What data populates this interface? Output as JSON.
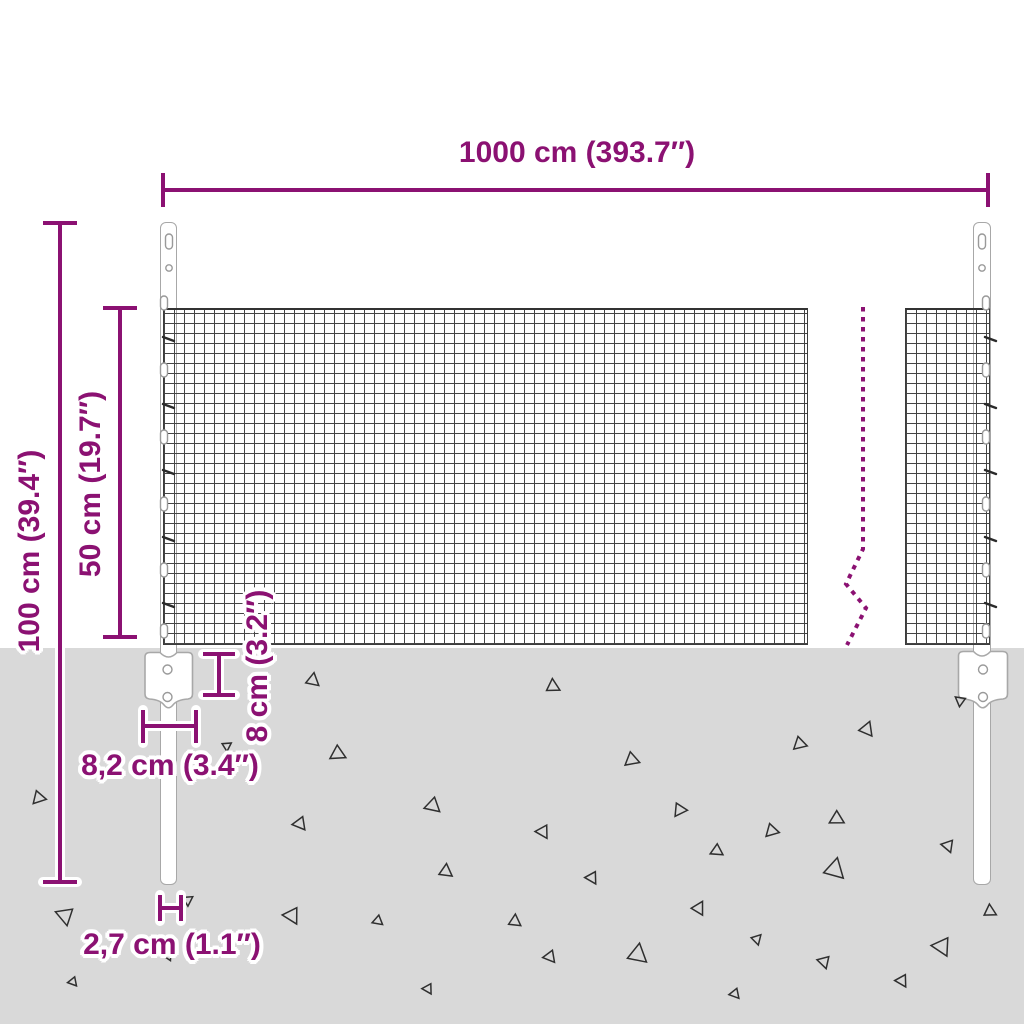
{
  "diagram": {
    "description": "Wire mesh fence with steel posts and ground anchor plates - dimension diagram",
    "labels": {
      "total_width": "1000 cm (393.7″)",
      "total_height": "100 cm (39.4″)",
      "mesh_height": "50 cm (19.7″)",
      "plate_height": "8 cm (3.2″)",
      "plate_width": "8,2 cm (3.4″)",
      "post_width": "2,7 cm (1.1″)"
    },
    "colors": {
      "dimension_annotation": "#8b1172",
      "ground": "#d9d9d9",
      "mesh_wire": "#454545",
      "post_outline": "#a8a8a8",
      "triangle_outline": "#2f2f2f"
    },
    "ground": {
      "texture": "scattered-triangle-marks",
      "triangles": [
        {
          "x": 313,
          "y": 680,
          "s": 13,
          "r": 8
        },
        {
          "x": 553,
          "y": 686,
          "s": 13,
          "r": 355
        },
        {
          "x": 867,
          "y": 729,
          "s": 14,
          "r": 20
        },
        {
          "x": 800,
          "y": 744,
          "s": 13,
          "r": 105
        },
        {
          "x": 960,
          "y": 701,
          "s": 10,
          "r": 185
        },
        {
          "x": 338,
          "y": 754,
          "s": 15,
          "r": 115
        },
        {
          "x": 632,
          "y": 760,
          "s": 14,
          "r": 108
        },
        {
          "x": 39,
          "y": 798,
          "s": 13,
          "r": 100
        },
        {
          "x": 433,
          "y": 806,
          "s": 15,
          "r": 130
        },
        {
          "x": 680,
          "y": 810,
          "s": 13,
          "r": 92
        },
        {
          "x": 837,
          "y": 819,
          "s": 14,
          "r": 118
        },
        {
          "x": 300,
          "y": 824,
          "s": 13,
          "r": 140
        },
        {
          "x": 543,
          "y": 832,
          "s": 13,
          "r": 148
        },
        {
          "x": 772,
          "y": 831,
          "s": 13,
          "r": 102
        },
        {
          "x": 717,
          "y": 851,
          "s": 12,
          "r": 122
        },
        {
          "x": 446,
          "y": 871,
          "s": 13,
          "r": 4
        },
        {
          "x": 835,
          "y": 869,
          "s": 20,
          "r": 12
        },
        {
          "x": 948,
          "y": 846,
          "s": 12,
          "r": 158
        },
        {
          "x": 592,
          "y": 878,
          "s": 12,
          "r": 148
        },
        {
          "x": 65,
          "y": 916,
          "s": 17,
          "r": 168
        },
        {
          "x": 188,
          "y": 900,
          "s": 10,
          "r": 55
        },
        {
          "x": 292,
          "y": 916,
          "s": 16,
          "r": 150
        },
        {
          "x": 378,
          "y": 921,
          "s": 10,
          "r": 128
        },
        {
          "x": 515,
          "y": 921,
          "s": 12,
          "r": 3
        },
        {
          "x": 699,
          "y": 908,
          "s": 13,
          "r": 28
        },
        {
          "x": 550,
          "y": 957,
          "s": 12,
          "r": 140
        },
        {
          "x": 638,
          "y": 954,
          "s": 19,
          "r": 8
        },
        {
          "x": 757,
          "y": 939,
          "s": 10,
          "r": 42
        },
        {
          "x": 824,
          "y": 962,
          "s": 12,
          "r": 162
        },
        {
          "x": 902,
          "y": 981,
          "s": 12,
          "r": 148
        },
        {
          "x": 942,
          "y": 947,
          "s": 18,
          "r": 152
        },
        {
          "x": 990,
          "y": 911,
          "s": 12,
          "r": 355
        },
        {
          "x": 735,
          "y": 994,
          "s": 10,
          "r": 138
        },
        {
          "x": 168,
          "y": 956,
          "s": 9,
          "r": 152
        },
        {
          "x": 73,
          "y": 982,
          "s": 9,
          "r": 138
        },
        {
          "x": 428,
          "y": 989,
          "s": 10,
          "r": 148
        },
        {
          "x": 227,
          "y": 746,
          "s": 9,
          "r": 55
        }
      ]
    }
  }
}
